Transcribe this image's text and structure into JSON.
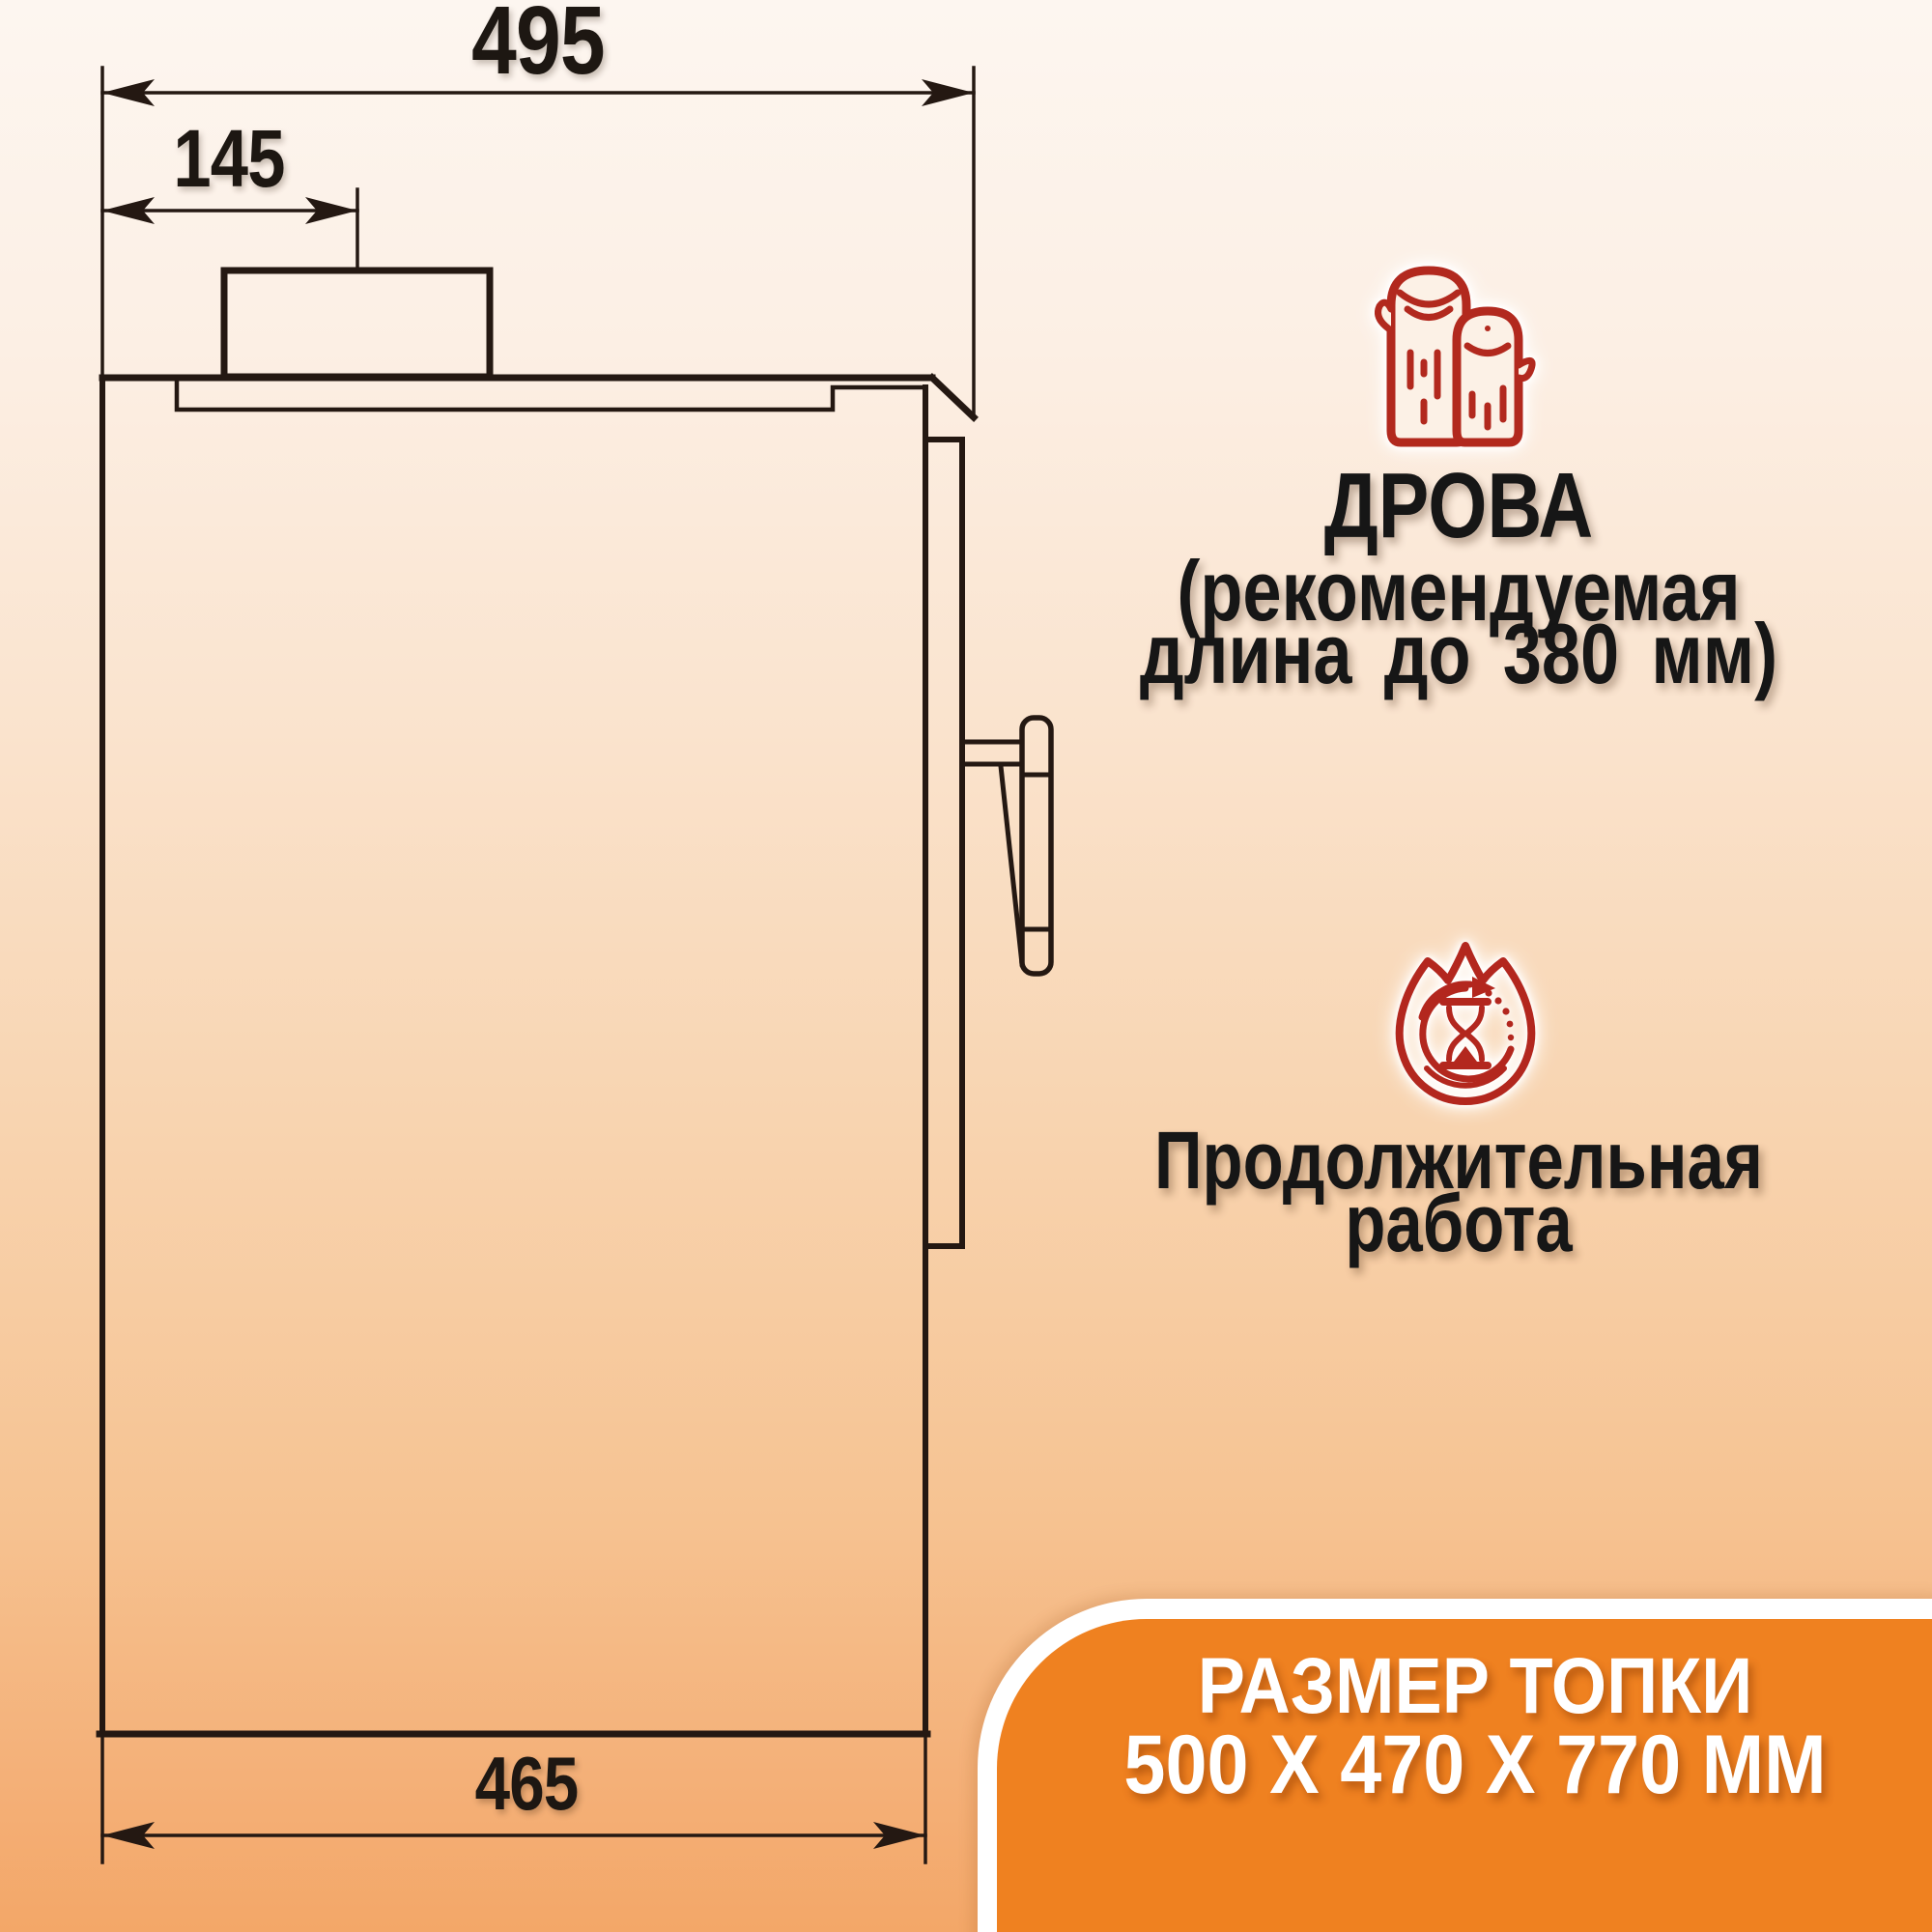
{
  "colors": {
    "background_top": "#FDF6F0",
    "background_bottom": "#F3A768",
    "accent_orange": "#EF8120",
    "icon_red": "#B2291E",
    "text_black": "#161616",
    "panel_text": "#FFFFFF",
    "drawing_line": "#241812"
  },
  "drawing": {
    "dim_overall_width": "495",
    "dim_flue_offset": "145",
    "dim_base_width": "465"
  },
  "features": [
    {
      "icon": "firewood-logs-icon",
      "title": "ДРОВА",
      "line2": "(рекомендуемая",
      "line3": "длина до 380 мм)"
    },
    {
      "icon": "flame-duration-icon",
      "line1": "Продолжительная",
      "line2": "работа"
    }
  ],
  "panel": {
    "title": "РАЗМЕР ТОПКИ",
    "dimensions": "500 Х 470 Х 770 ММ"
  }
}
